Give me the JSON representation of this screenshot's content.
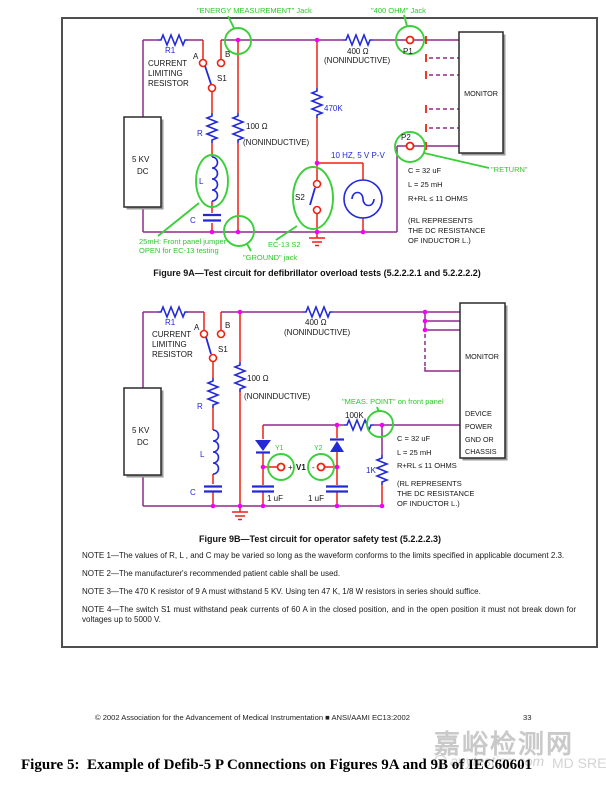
{
  "fig9a": {
    "caption": "Figure 9A—Test circuit for defibrillator overload tests (5.2.2.2.1 and 5.2.2.2.2)",
    "r1": "R1",
    "current_limiting": [
      "CURRENT",
      "LIMITING",
      "RESISTOR"
    ],
    "a": "A",
    "b": "B",
    "s1": "S1",
    "s2": "S2",
    "r": "R",
    "l": "L",
    "c": "C",
    "r100": "100 Ω",
    "r400": "400 Ω",
    "r470k": "470K",
    "noninductive": "(NONINDUCTIVE)",
    "sine": "10 HZ, 5 V P-V",
    "p1": "P1",
    "p2": "P2",
    "source": [
      "5 KV",
      "DC"
    ],
    "monitor": "MONITOR",
    "specs": [
      "C = 32 uF",
      "L = 25 mH",
      "R+RL ≤ 11 OHMS",
      "(RL REPRESENTS",
      "THE DC RESISTANCE",
      "OF INDUCTOR L.)"
    ],
    "jack_energy": "\"ENERGY MEASUREMENT\" Jack",
    "jack_400": "\"400 OHM\" Jack",
    "jack_ground": "\"GROUND\" jack",
    "jack_return": "\"RETURN\"",
    "jumper_note": [
      "25mH:  Front panel jumper",
      "OPEN for EC-13 testing"
    ],
    "ec13_s2": "EC-13 S2"
  },
  "fig9b": {
    "caption": "Figure 9B—Test circuit for operator safety test (5.2.2.2.3)",
    "r1": "R1",
    "current_limiting": [
      "CURRENT",
      "LIMITING",
      "RESISTOR"
    ],
    "a": "A",
    "b": "B",
    "s1": "S1",
    "r": "R",
    "l": "L",
    "c": "C",
    "r100": "100 Ω",
    "r400": "400 Ω",
    "r100k": "100K",
    "r1k": "1K",
    "noninductive": "(NONINDUCTIVE)",
    "source": [
      "5 KV",
      "DC"
    ],
    "y1": "Y1",
    "y2": "Y2",
    "v1": "V1",
    "plus": "+",
    "minus": "-",
    "cap1": "1 uF",
    "monitor": "MONITOR",
    "device": [
      "DEVICE",
      "POWER",
      "GND OR",
      "CHASSIS"
    ],
    "specs": [
      "C = 32 uF",
      "L = 25 mH",
      "R+RL ≤ 11 OHMS",
      "(RL REPRESENTS",
      "THE DC RESISTANCE",
      "OF INDUCTOR L.)"
    ],
    "meas_point": "\"MEAS. POINT\" on front panel"
  },
  "notes": [
    "NOTE 1—The values of R, L , and C may be varied so long as the waveform conforms to the limits specified in applicable document 2.3.",
    "NOTE 2—The manufacturer's recommended patient cable shall be used.",
    "NOTE 3—The 470 K resistor of 9 A must withstand 5 KV. Using ten 47 K, 1/8 W resistors in series should suffice.",
    "NOTE 4—The switch S1 must withstand peak currents of 60 A in the closed position, and in the open position it must not break down for voltages up to 5000 V."
  ],
  "footer": {
    "copyright": "© 2002 Association for the Advancement of Medical Instrumentation ■ ANSI/AAMI EC13:2002",
    "page_number": "33"
  },
  "figure_caption": "Figure 5:  Example of Defib-5 P Connections on Figures 9A and 9B of IEC60601",
  "watermark": {
    "site_name": "嘉峪检测网",
    "site_domain": "anytesting.com",
    "overlay": "MD SRE,"
  }
}
